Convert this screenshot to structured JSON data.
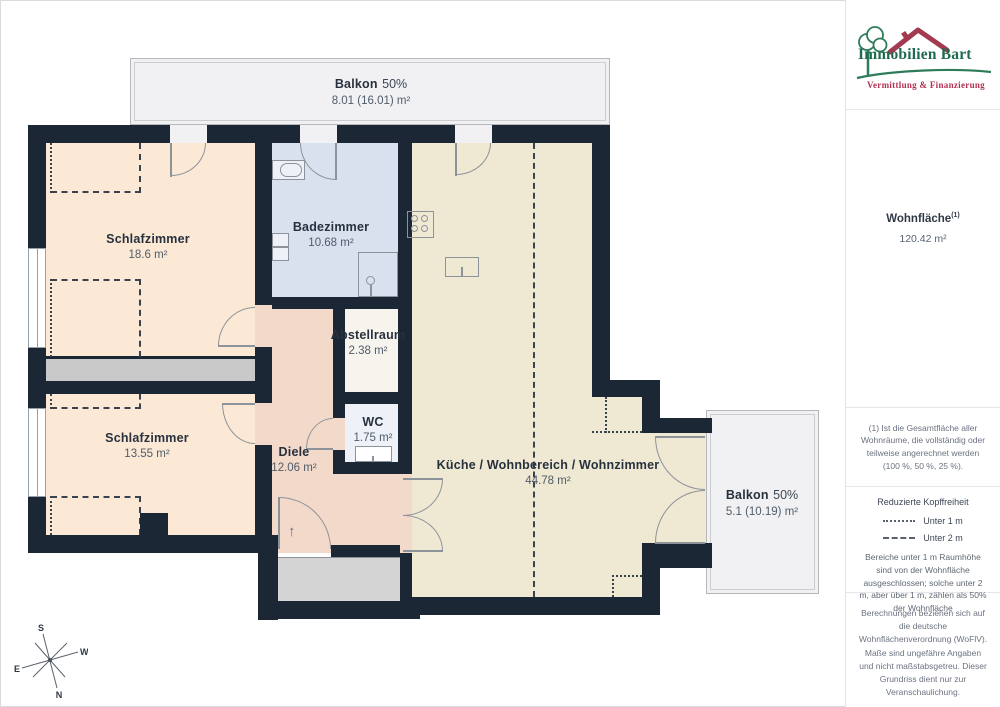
{
  "plan": {
    "rooms": [
      {
        "name": "Schlafzimmer",
        "area": "18.6 m²"
      },
      {
        "name": "Schlafzimmer",
        "area": "13.55 m²"
      },
      {
        "name": "Badezimmer",
        "area": "10.68 m²"
      },
      {
        "name": "Abstellraum",
        "area": "2.38 m²"
      },
      {
        "name": "WC",
        "area": "1.75 m²"
      },
      {
        "name": "Diele",
        "area": "12.06 m²"
      },
      {
        "name": "Küche / Wohnbereich / Wohnzimmer",
        "area": "44.78 m²"
      }
    ],
    "balconies": [
      {
        "name": "Balkon",
        "share": "50%",
        "area": "8.01 (16.01) m²"
      },
      {
        "name": "Balkon",
        "share": "50%",
        "area": "5.1 (10.19) m²"
      }
    ],
    "compass": {
      "n": "N",
      "s": "S",
      "e": "E",
      "w": "W"
    },
    "icons": {
      "entrance_arrow": "↑"
    }
  },
  "sidebar": {
    "logo": {
      "line1": "Immobilien Bart",
      "line2": "Vermittlung & Finanzierung"
    },
    "area_summary": {
      "title": "Wohnfläche",
      "superscript": "(1)",
      "value": "120.42 m²"
    },
    "footnote": "(1) Ist die Gesamtfläche aller Wohnräume, die vollständig oder teilweise angerechnet werden (100 %, 50 %, 25 %).",
    "legend": {
      "title": "Reduzierte Kopffreiheit",
      "items": [
        {
          "style": "dotted",
          "label": "Unter 1 m"
        },
        {
          "style": "dashed",
          "label": "Unter 2 m"
        }
      ],
      "note": "Bereiche unter 1 m Raumhöhe sind von der Wohnfläche ausgeschlossen; solche unter 2 m, aber über 1 m, zählen als 50% der Wohnfläche"
    },
    "disclaimer": "Berechnungen beziehen sich auf die deutsche Wohnflächenverordnung (WoFlV). Maße sind ungefähre Angaben und nicht maßstabsgetreu. Dieser Grundriss dient nur zur Veranschaulichung.",
    "brand": {
      "name": "GIRAFFE",
      "suffix": "360"
    }
  },
  "colors": {
    "wall": "#1c2736",
    "bedroom": "#fbe9d6",
    "bathroom": "#d9e1ee",
    "wc": "#eef1f7",
    "storage": "#f7f4ee",
    "hallway": "#f3d9ca",
    "living": "#efe8d2",
    "balcony": "#f1f1f3",
    "brand_green": "#2e7c5a",
    "brand_red": "#a23a50",
    "accent_red": "#b13052"
  }
}
